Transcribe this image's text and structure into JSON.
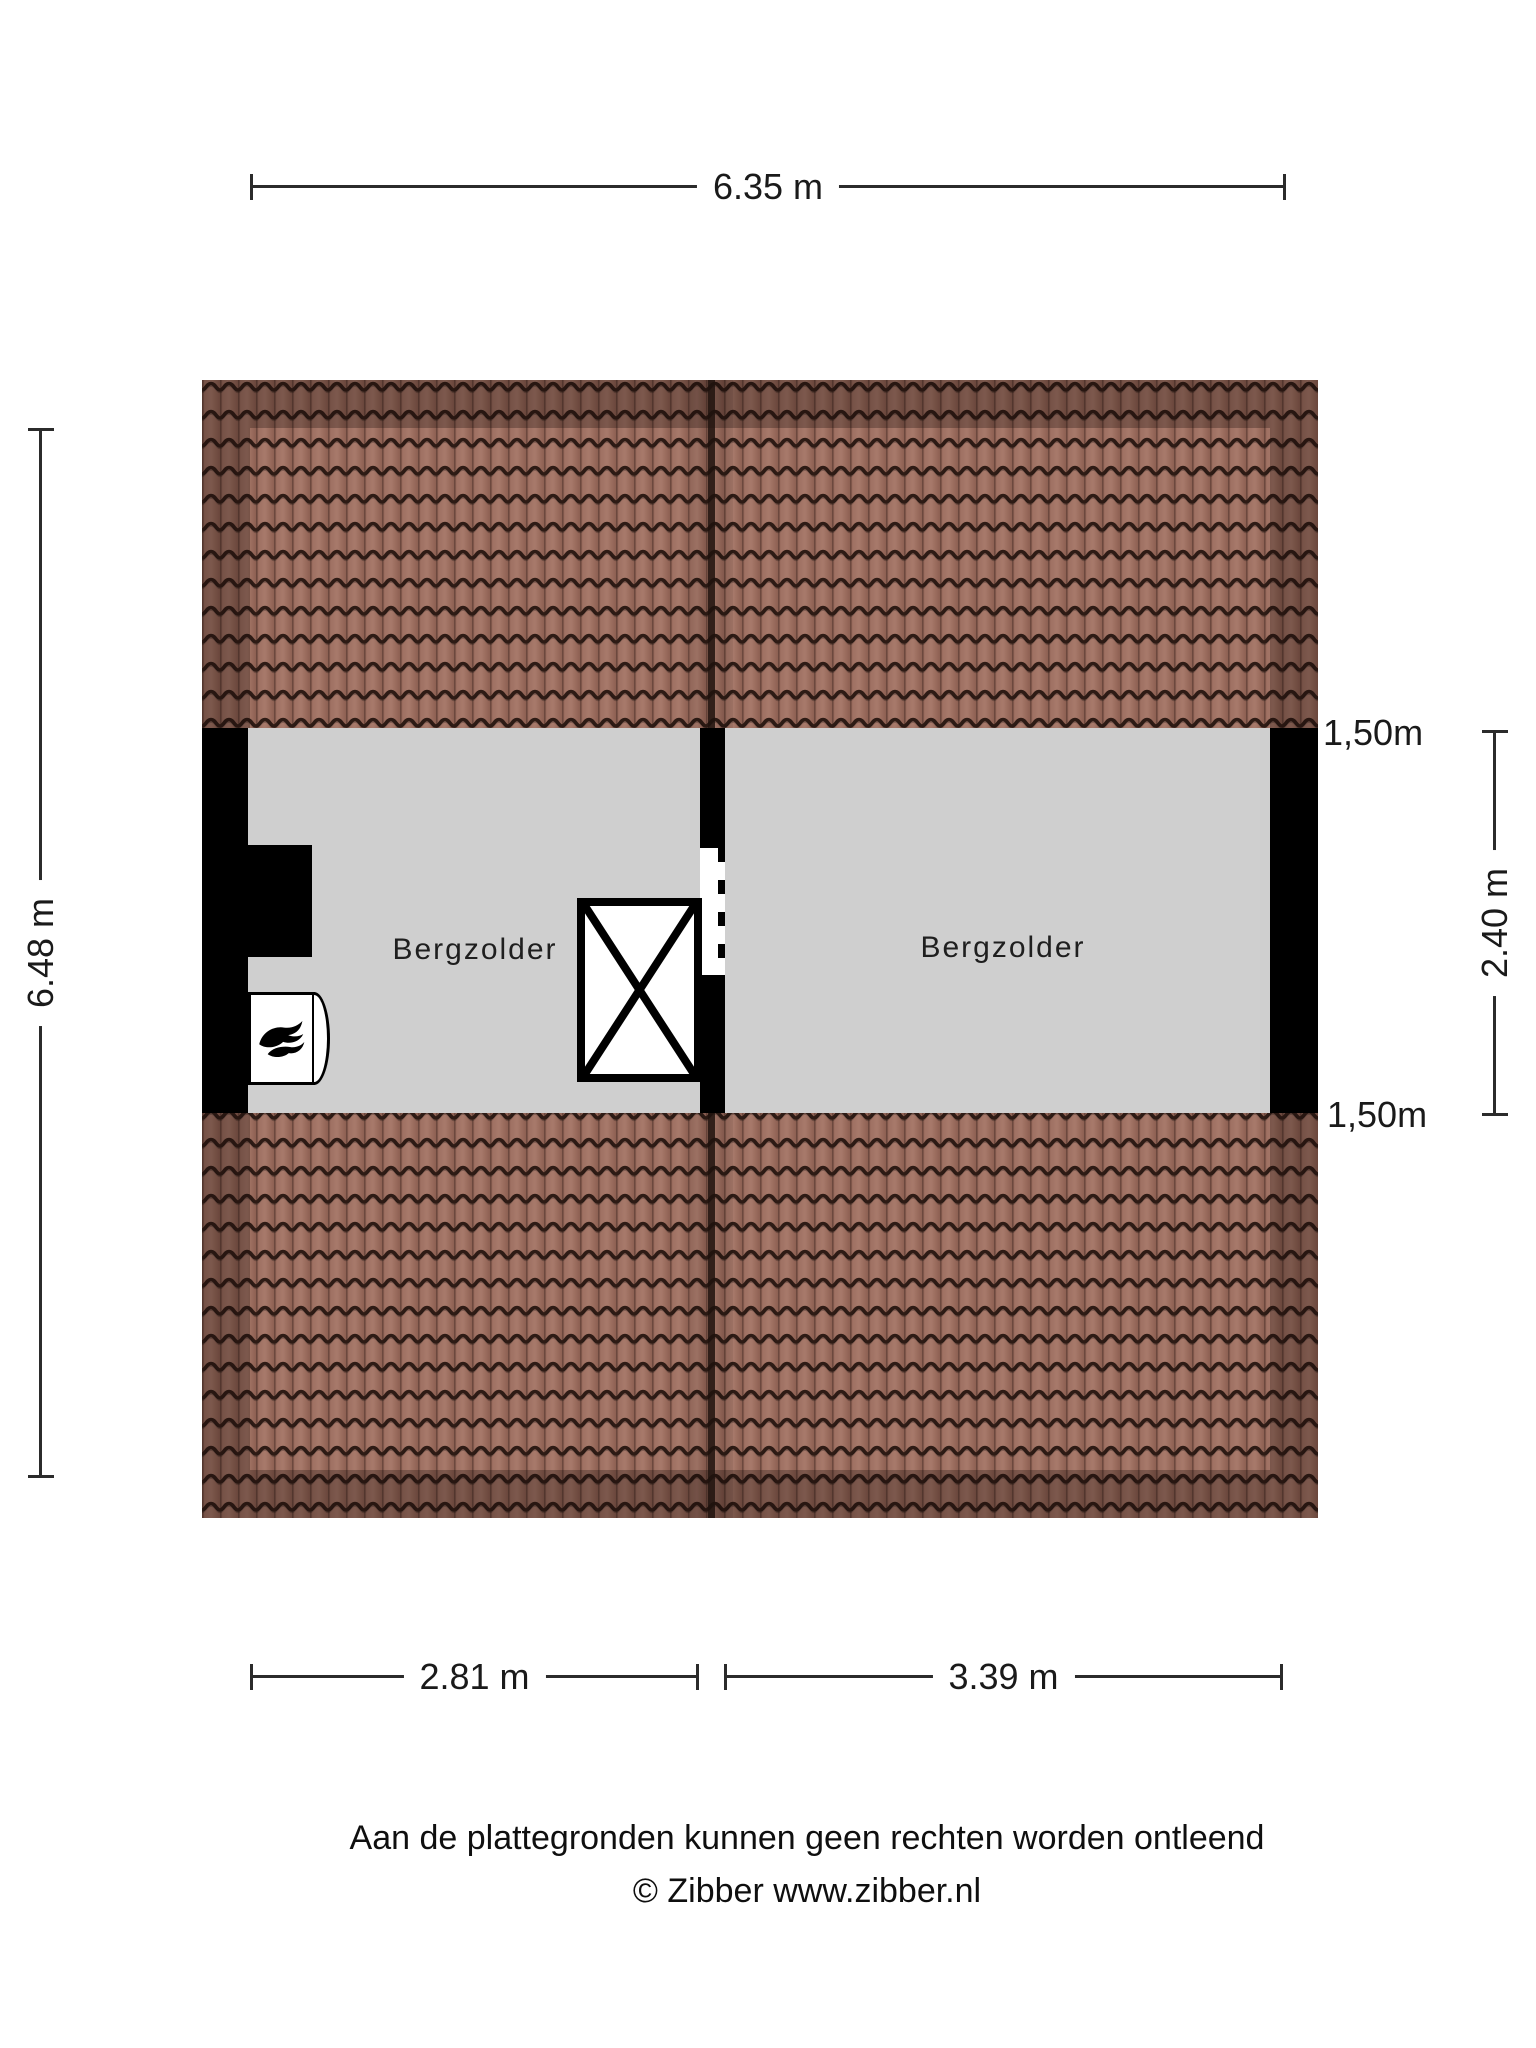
{
  "dimensions": {
    "top_width": "6.35 m",
    "left_height": "6.48 m",
    "right_height": "2.40 m",
    "bottom_left_width": "2.81 m",
    "bottom_right_width": "3.39 m",
    "headroom_top": "1,50m",
    "headroom_bottom": "1,50m"
  },
  "rooms": [
    {
      "label": "Bergzolder"
    },
    {
      "label": "Bergzolder"
    }
  ],
  "footer": {
    "disclaimer": "Aan de plattegronden kunnen geen rechten worden ontleend",
    "copyright": "© Zibber www.zibber.nl"
  },
  "colors": {
    "roof_tile": "#a07365",
    "roof_tile_dark": "#7d564b",
    "roof_line": "#2e1b15",
    "floor": "#cfcfcf",
    "wall": "#000000",
    "dimension_line": "#2b2b2b"
  }
}
